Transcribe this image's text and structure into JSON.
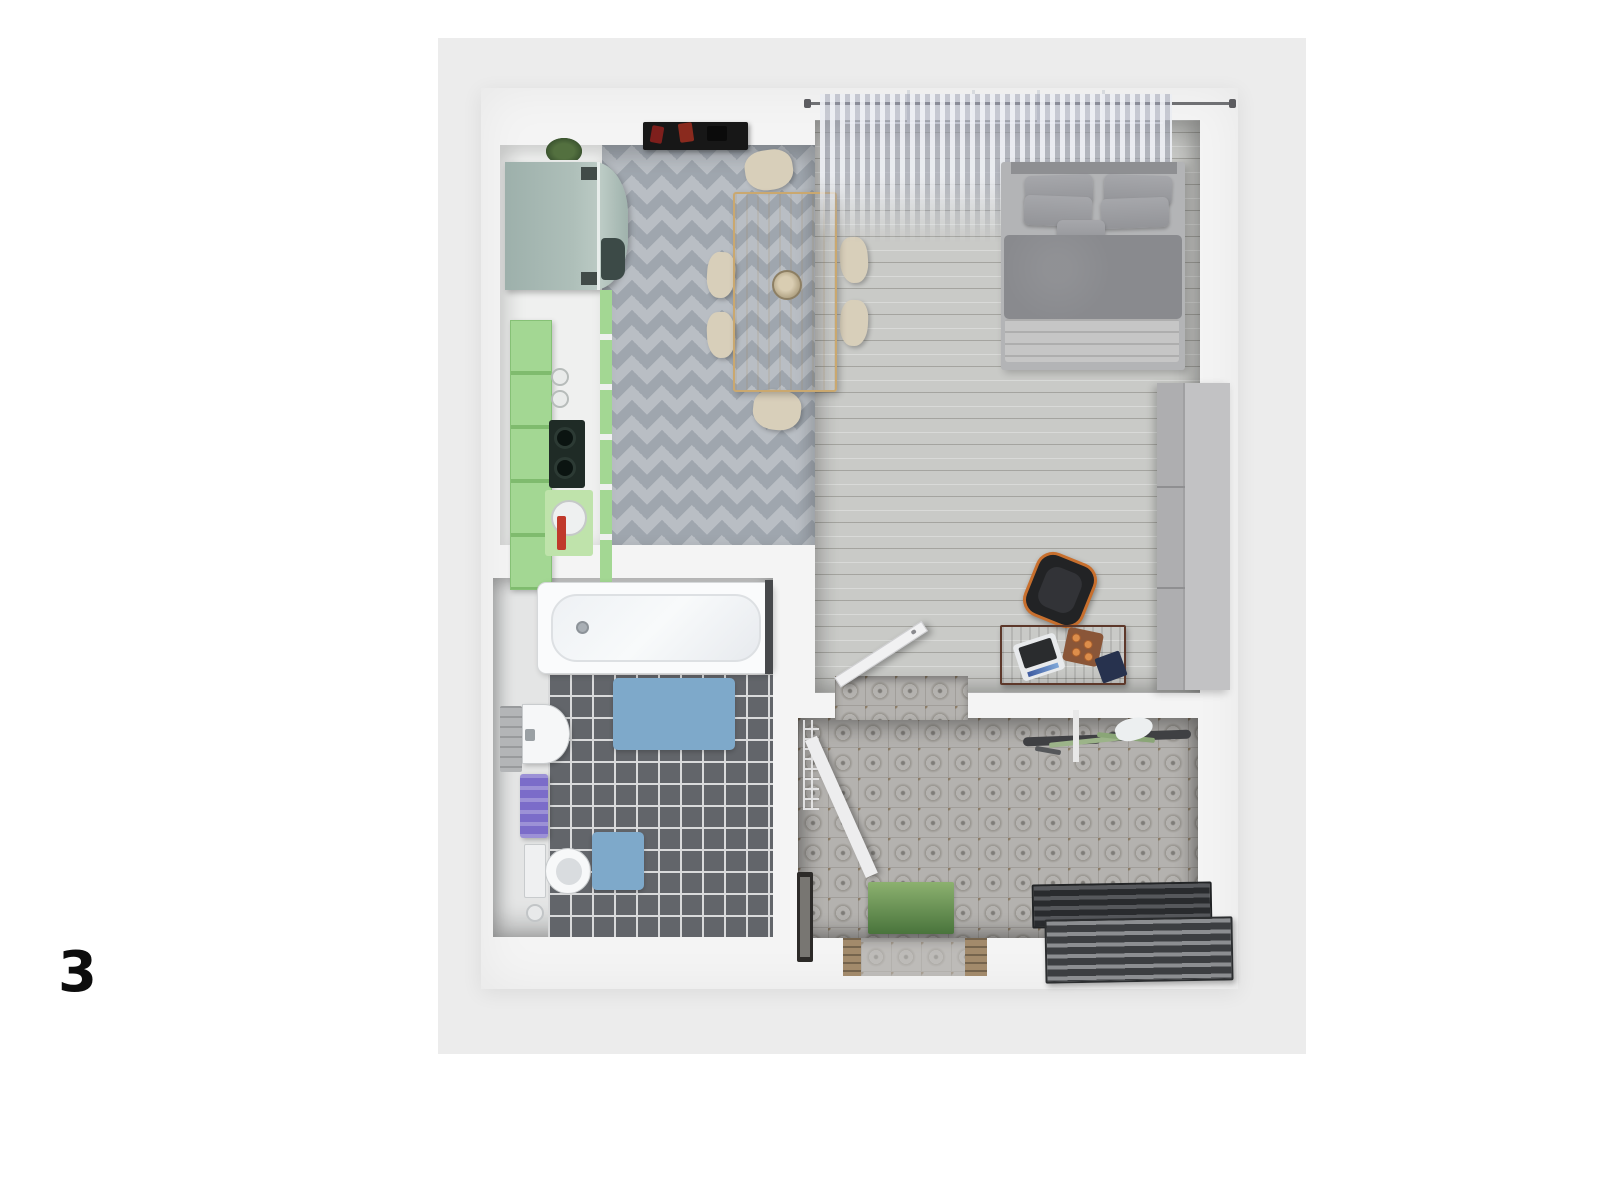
{
  "page": {
    "figure_label": "3",
    "background": "#ffffff",
    "canvas_background": "#ececec"
  },
  "floorplan": {
    "type": "top-down 3D apartment render",
    "rooms": [
      "kitchen-dining",
      "bedroom-living-room",
      "bathroom",
      "hallway-entry"
    ],
    "furniture": [
      "fridge",
      "green-kitchen-cabinets",
      "stove",
      "kitchen-sink",
      "wall-shelf",
      "plant",
      "dining-table",
      "six-chairs",
      "fruit-bowl",
      "window-curtains",
      "double-bed",
      "pillows",
      "duvet",
      "blanket",
      "wardrobe",
      "desk",
      "laptop",
      "candle-tray",
      "notebook",
      "office-chair",
      "open-door",
      "bathtub",
      "washbasin",
      "towel",
      "toilet",
      "bath-mats",
      "toilet-brush",
      "ladder-plank",
      "wall-lattice",
      "mirror",
      "doormat",
      "bicycle",
      "slatted-bench",
      "entry-threshold"
    ],
    "colors": {
      "wall": "#f4f4f4",
      "kitchen_tile_base": "#b9bec4",
      "kitchen_tile_diamond": "#9fa6ae",
      "wood_floor": "#c9cac7",
      "bath_tile": "#62656a",
      "hall_tile": "#b4b2af",
      "cabinet_green": "#a3d793",
      "fridge_teal": "#aebfb9",
      "table_wood": "#e2c48c",
      "chair_cream": "#d8cfba",
      "bed_gray": "#898a8e",
      "mat_blue": "#7ea9ca",
      "towel_purple": "#7b6cc9",
      "doormat_green": "#49743c",
      "desk_wood": "#7d4c35",
      "chair_accent_orange": "#c86f2d",
      "bike_green": "#9cb489",
      "bench_dark": "#3a3c3f"
    }
  }
}
